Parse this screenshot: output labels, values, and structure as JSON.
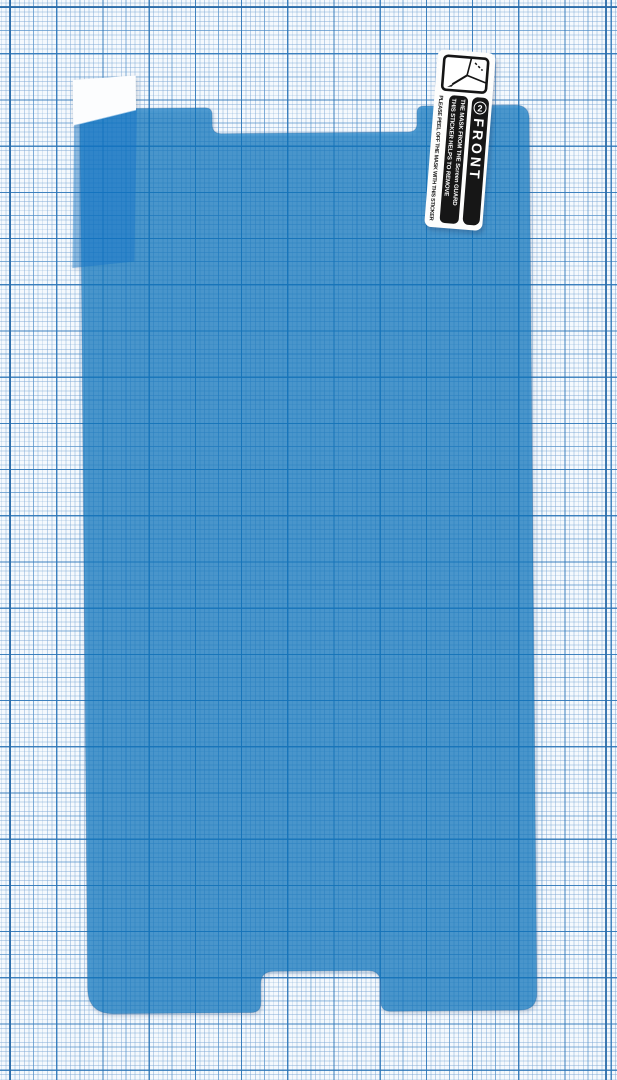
{
  "sticker": {
    "icon": "peel-corner-icon",
    "badge_number": "2",
    "front_label": "FRONT",
    "line1": "THIS STICKER HELPS TO REMOVE",
    "line2": "THE MASK FROM THE Screen GUARD",
    "footer": "PLEASE PEEL OFF THE MASK WITH THIS STICKER"
  },
  "colors": {
    "paper_bg": "#f5f9fd",
    "grid_fine": "#7da8d4",
    "grid_medium": "#468ac6",
    "grid_bold": "#2c75b7",
    "paper_margin_line": "#2b6ba8",
    "film_blue": "#0876c2",
    "pull_tab_blue": "#0f76c8",
    "pull_tab_tip": "#fcfdfe",
    "sticker_bg": "#fdfdfc",
    "band_bg": "#161616",
    "band_text": "#ffffff",
    "sticker_text": "#1a1a1a"
  }
}
